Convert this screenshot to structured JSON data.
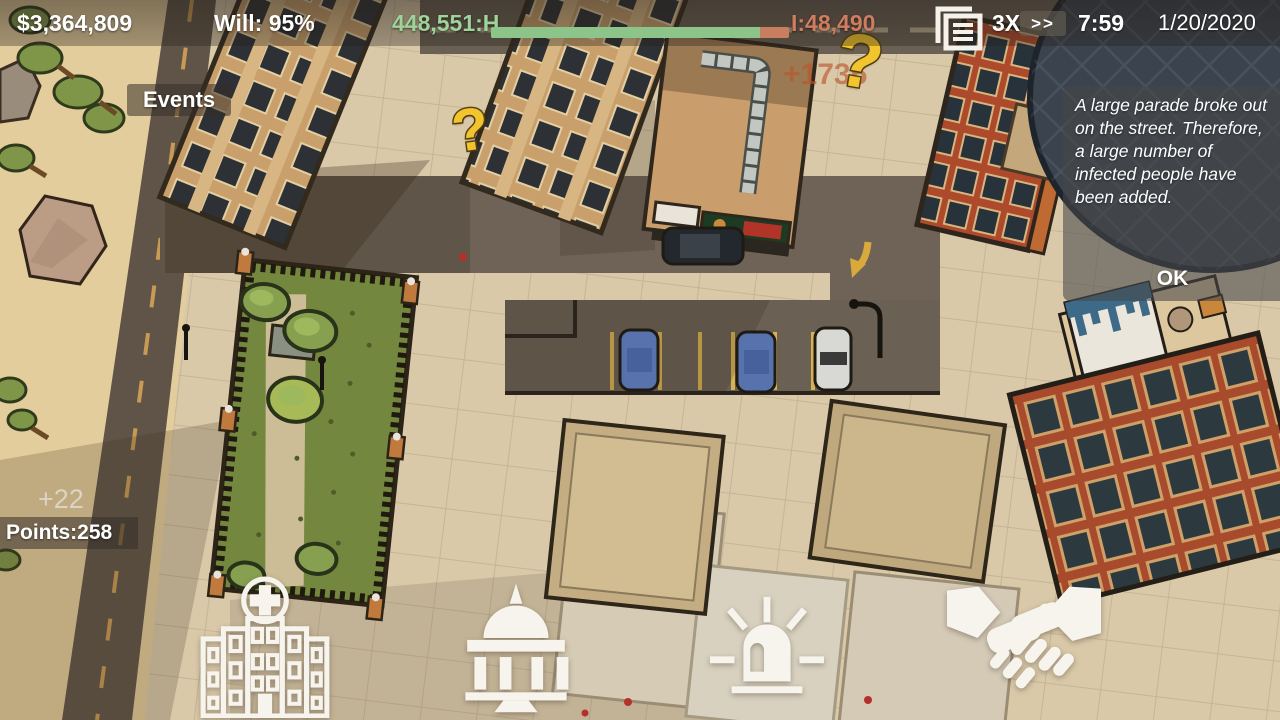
{
  "hud": {
    "money": "$3,364,809",
    "will_label": "Will: 95%",
    "healthy_count": "448,551:H",
    "infected_count": "I:48,490",
    "health_bar": {
      "healthy": 448551,
      "infected": 48490,
      "healthy_pct": 90.2
    },
    "speed_label": "3X",
    "speed_arrows": ">>",
    "clock_time": "7:59",
    "date": "1/20/2020"
  },
  "events_button": {
    "label": "Events"
  },
  "event_dialog": {
    "message": "A large parade broke out on the street. Therefore, a large number of infected people have been added.",
    "ok_label": "OK"
  },
  "score": {
    "points_label": "Points:258",
    "points_gain": "+22"
  },
  "floating_markers": {
    "infected_gain": "+1735",
    "question_mark_1": "?",
    "question_mark_2": "?"
  },
  "action_bar": {
    "buttons": [
      {
        "id": "hospital",
        "icon": "hospital-icon"
      },
      {
        "id": "government",
        "icon": "government-icon"
      },
      {
        "id": "emergency",
        "icon": "siren-icon"
      },
      {
        "id": "diplomacy",
        "icon": "handshake-icon"
      }
    ]
  },
  "colors": {
    "healthy_green_text": "#9ed39a",
    "bar_green": "#8dc489",
    "infected_salmon": "#cf7c5f",
    "question_yellow": "#f2c52e",
    "hud_text": "#ffffff"
  }
}
